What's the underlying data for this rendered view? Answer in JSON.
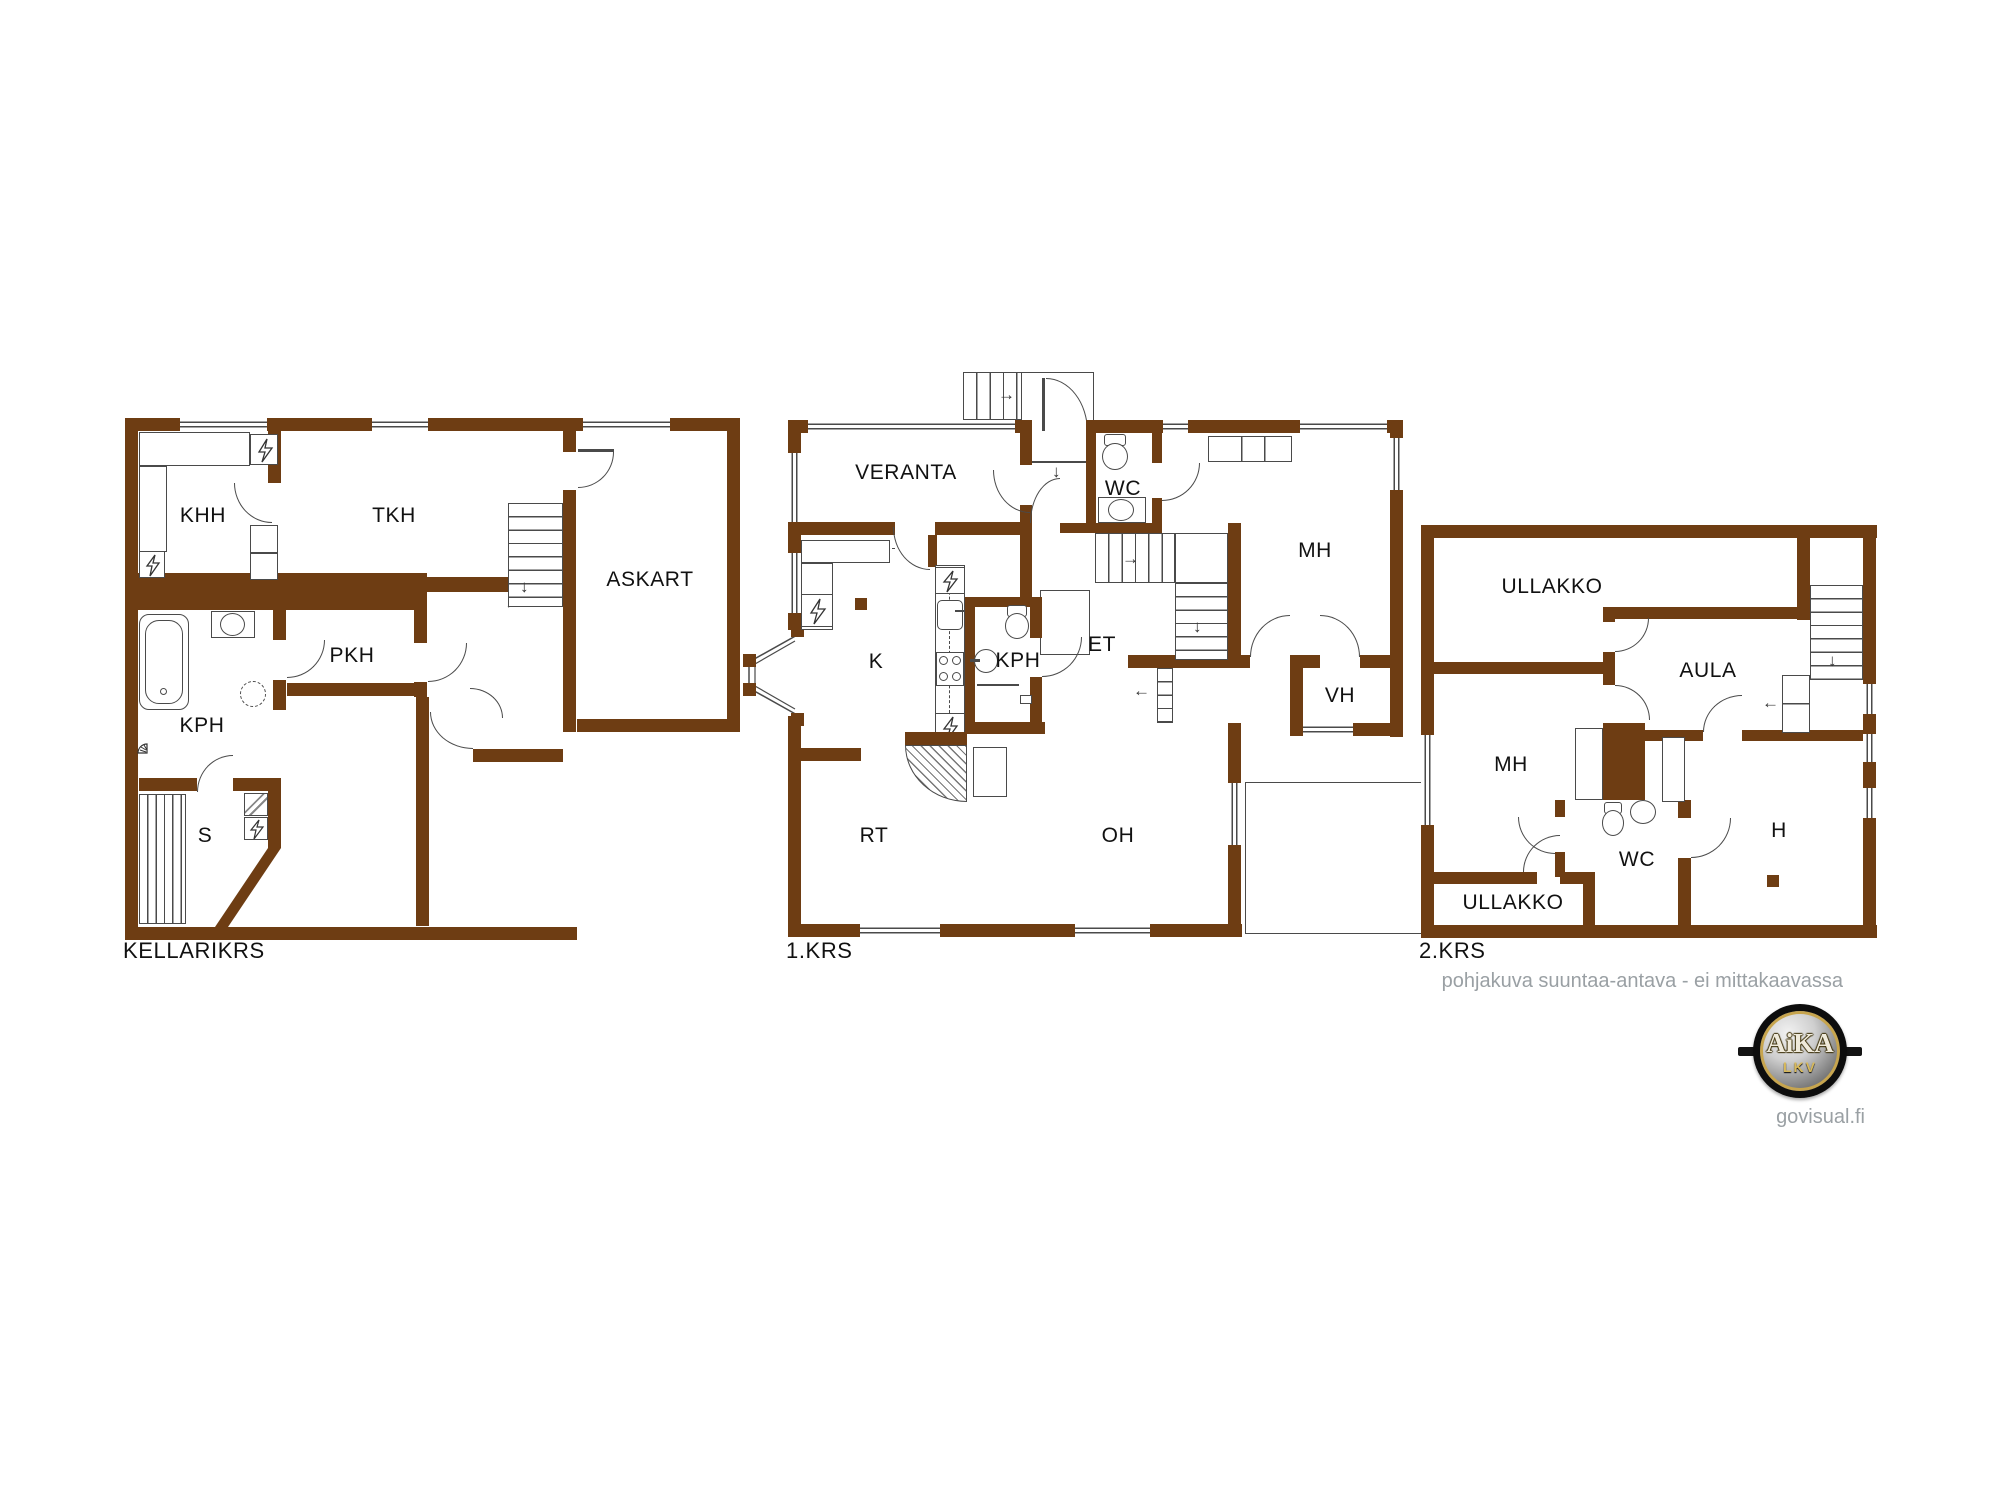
{
  "floors": {
    "basement": {
      "title": "KELLARIKRS",
      "rooms": {
        "khh": "KHH",
        "tkh": "TKH",
        "askart": "ASKART",
        "pkh": "PKH",
        "kph": "KPH",
        "s": "S"
      }
    },
    "first": {
      "title": "1.KRS",
      "rooms": {
        "veranta": "VERANTA",
        "wc": "WC",
        "mh": "MH",
        "k": "K",
        "kph": "KPH",
        "et": "ET",
        "vh": "VH",
        "rt": "RT",
        "oh": "OH"
      }
    },
    "second": {
      "title": "2.KRS",
      "rooms": {
        "ullakko_top": "ULLAKKO",
        "aula": "AULA",
        "mh": "MH",
        "wc": "WC",
        "h": "H",
        "ullakko_bottom": "ULLAKKO"
      }
    }
  },
  "footer": {
    "disclaimer": "pohjakuva suuntaa-antava - ei mittakaavassa",
    "website": "govisual.fi"
  },
  "logo": {
    "name": "AiKA",
    "sub": "LKV"
  },
  "symbols": {
    "arrow_right": "→",
    "arrow_down": "↓",
    "arrow_left": "←"
  },
  "colors": {
    "wall": "#6e3d13",
    "line": "#4a4a4a",
    "text": "#111111",
    "muted": "#9aa0a4"
  }
}
